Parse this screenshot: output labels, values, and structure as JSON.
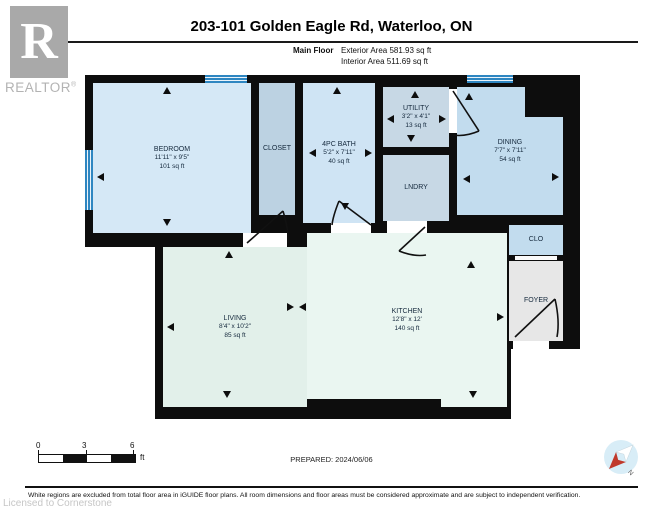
{
  "header": {
    "logo_letter": "R",
    "logo_word": "REALTOR",
    "logo_reg": "®",
    "title": "203-101 Golden Eagle Rd, Waterloo, ON",
    "floor_label": "Main Floor",
    "exterior_area": "Exterior Area 581.93 sq ft",
    "interior_area": "Interior Area 511.69 sq ft"
  },
  "plan": {
    "rooms": {
      "bedroom": {
        "name": "BEDROOM",
        "dims": "11'11\" x 9'5\"",
        "area": "101 sq ft"
      },
      "closet": {
        "name": "CLOSET"
      },
      "bath": {
        "name": "4PC BATH",
        "dims": "5'2\" x 7'11\"",
        "area": "40 sq ft"
      },
      "utility": {
        "name": "UTILITY",
        "dims": "3'2\" x 4'1\"",
        "area": "13 sq ft"
      },
      "laundry": {
        "name": "LNDRY"
      },
      "dining": {
        "name": "DINING",
        "dims": "7'7\" x 7'11\"",
        "area": "54 sq ft"
      },
      "clo": {
        "name": "CLO"
      },
      "foyer": {
        "name": "FOYER"
      },
      "living": {
        "name": "LIVING",
        "dims": "8'4\" x 10'2\"",
        "area": "85 sq ft"
      },
      "kitchen": {
        "name": "KITCHEN",
        "dims": "12'8\" x 12'",
        "area": "140 sq ft"
      }
    },
    "colors": {
      "wall": "#0d0d0d",
      "room_blue": "#cfe4f4",
      "room_blue_dark": "#bcd2e2",
      "room_mint": "#e2f0ea",
      "foyer_gray": "#e7e7e7",
      "window_blue": "#2e86c1"
    }
  },
  "footer": {
    "scale": {
      "tick_0": "0",
      "tick_3": "3",
      "tick_6": "6",
      "unit": "ft"
    },
    "prepared": "PREPARED: 2024/06/06",
    "compass_label": "N",
    "disclaimer": "White regions are excluded from total floor area in iGUIDE floor plans. All room dimensions and floor areas must be considered approximate and are subject to independent verification.",
    "license": "Licensed to Cornerstone"
  }
}
